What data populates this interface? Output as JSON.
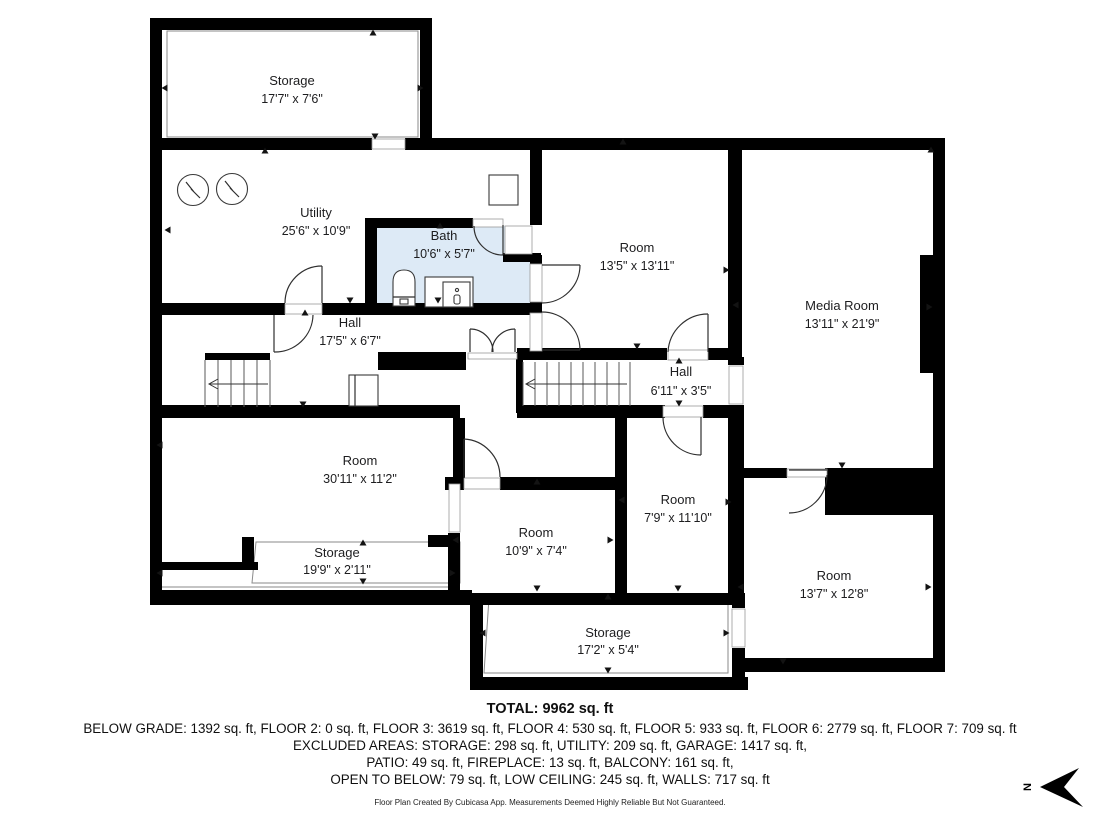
{
  "document": {
    "type": "floor-plan"
  },
  "rooms": [
    {
      "id": "storage-top",
      "name": "Storage",
      "dims": "17'7\" x 7'6\""
    },
    {
      "id": "utility",
      "name": "Utility",
      "dims": "25'6\" x 10'9\""
    },
    {
      "id": "bath",
      "name": "Bath",
      "dims": "10'6\" x 5'7\""
    },
    {
      "id": "room-top-middle",
      "name": "Room",
      "dims": "13'5\" x 13'11\""
    },
    {
      "id": "media-room",
      "name": "Media Room",
      "dims": "13'11\" x 21'9\""
    },
    {
      "id": "hall-left",
      "name": "Hall",
      "dims": "17'5\" x 6'7\""
    },
    {
      "id": "hall-center",
      "name": "Hall",
      "dims": "6'11\" x 3'5\""
    },
    {
      "id": "room-left",
      "name": "Room",
      "dims": "30'11\" x 11'2\""
    },
    {
      "id": "storage-strip",
      "name": "Storage",
      "dims": "19'9\" x 2'11\""
    },
    {
      "id": "room-bottom-middle",
      "name": "Room",
      "dims": "10'9\" x 7'4\""
    },
    {
      "id": "room-bottom-center",
      "name": "Room",
      "dims": "7'9\" x 11'10\""
    },
    {
      "id": "room-bottom-right",
      "name": "Room",
      "dims": "13'7\" x 12'8\""
    },
    {
      "id": "storage-bottom",
      "name": "Storage",
      "dims": "17'2\" x 5'4\""
    }
  ],
  "summary": {
    "total": "TOTAL: 9962 sq. ft",
    "line1": "BELOW GRADE: 1392 sq. ft, FLOOR 2: 0 sq. ft, FLOOR 3: 3619 sq. ft, FLOOR 4: 530 sq. ft, FLOOR 5: 933 sq. ft, FLOOR 6: 2779 sq. ft, FLOOR 7: 709 sq. ft",
    "line2": "EXCLUDED AREAS: STORAGE: 298 sq. ft, UTILITY: 209 sq. ft, GARAGE: 1417 sq. ft,",
    "line3": "PATIO: 49 sq. ft, FIREPLACE: 13 sq. ft, BALCONY: 161 sq. ft,",
    "line4": "OPEN TO BELOW: 79 sq. ft, LOW CEILING: 245 sq. ft, WALLS: 717 sq. ft"
  },
  "footer": "Floor Plan Created By Cubicasa App. Measurements Deemed Highly Reliable But Not Guaranteed.",
  "compass": {
    "label": "N"
  },
  "colors": {
    "wall": "#000000",
    "bath_fill": "#ddeaf6",
    "text": "#1c1c1c"
  }
}
